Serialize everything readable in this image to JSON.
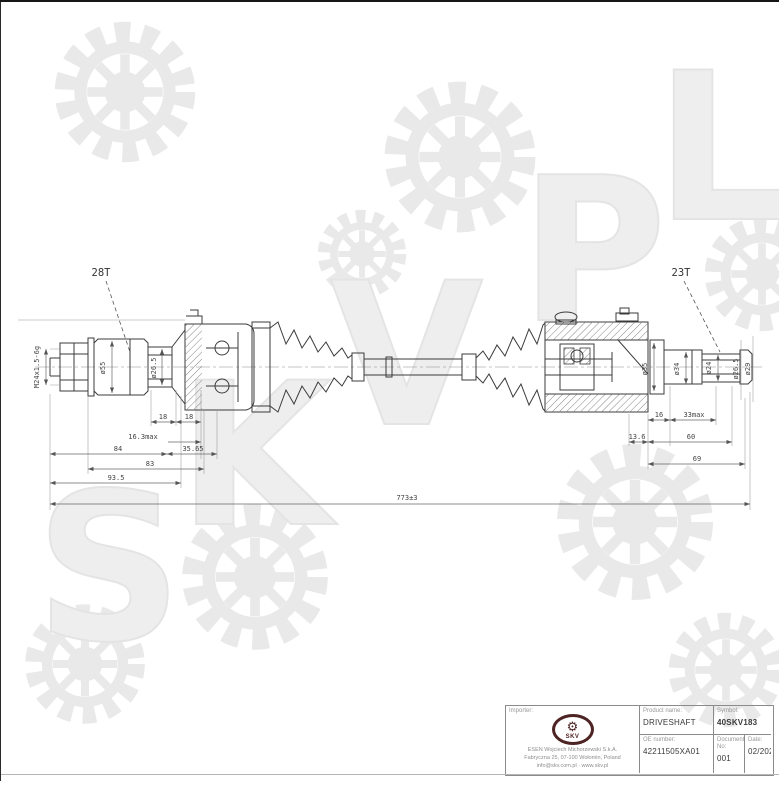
{
  "watermark": {
    "letters": [
      "S",
      "K",
      "V",
      "P",
      "L"
    ]
  },
  "drawing": {
    "callouts": {
      "left_spline": "28T",
      "right_spline": "23T"
    },
    "thread_spec": "M24x1.5-6g",
    "diameters": {
      "left_stem": "ø55",
      "left_spline": "ø26.5",
      "right_housing": "ø35",
      "right_stem": "ø34",
      "right_spline": "ø24",
      "right_pilot": "ø26.5",
      "right_end": "ø29"
    },
    "dims_left": {
      "seg_a": "18",
      "seg_b": "18",
      "max": "16.3max",
      "len_a": "84",
      "len_b": "35.65",
      "len_c": "83",
      "len_d": "93.5"
    },
    "dims_right": {
      "seg_a": "16",
      "max": "33max",
      "seg_b": "13.6",
      "len_a": "60",
      "len_b": "69"
    },
    "overall_length": "773±3"
  },
  "title_block": {
    "importer_label": "Importer:",
    "logo_text": "SKV",
    "address_lines": [
      "ESEN Wojciech Michorzewski S.k.A.",
      "Fabryczna 25, 07-100 Wołomin, Poland",
      "info@skv.com.pl · www.skv.pl"
    ],
    "product_label": "Product name:",
    "product_value": "DRIVESHAFT",
    "symbol_label": "Symbol:",
    "symbol_value": "40SKV183",
    "oe_label": "OE number:",
    "oe_value": "42211505XA01",
    "doc_label": "Document No:",
    "doc_value": "001",
    "date_label": "Date:",
    "date_value": "02/2025"
  }
}
